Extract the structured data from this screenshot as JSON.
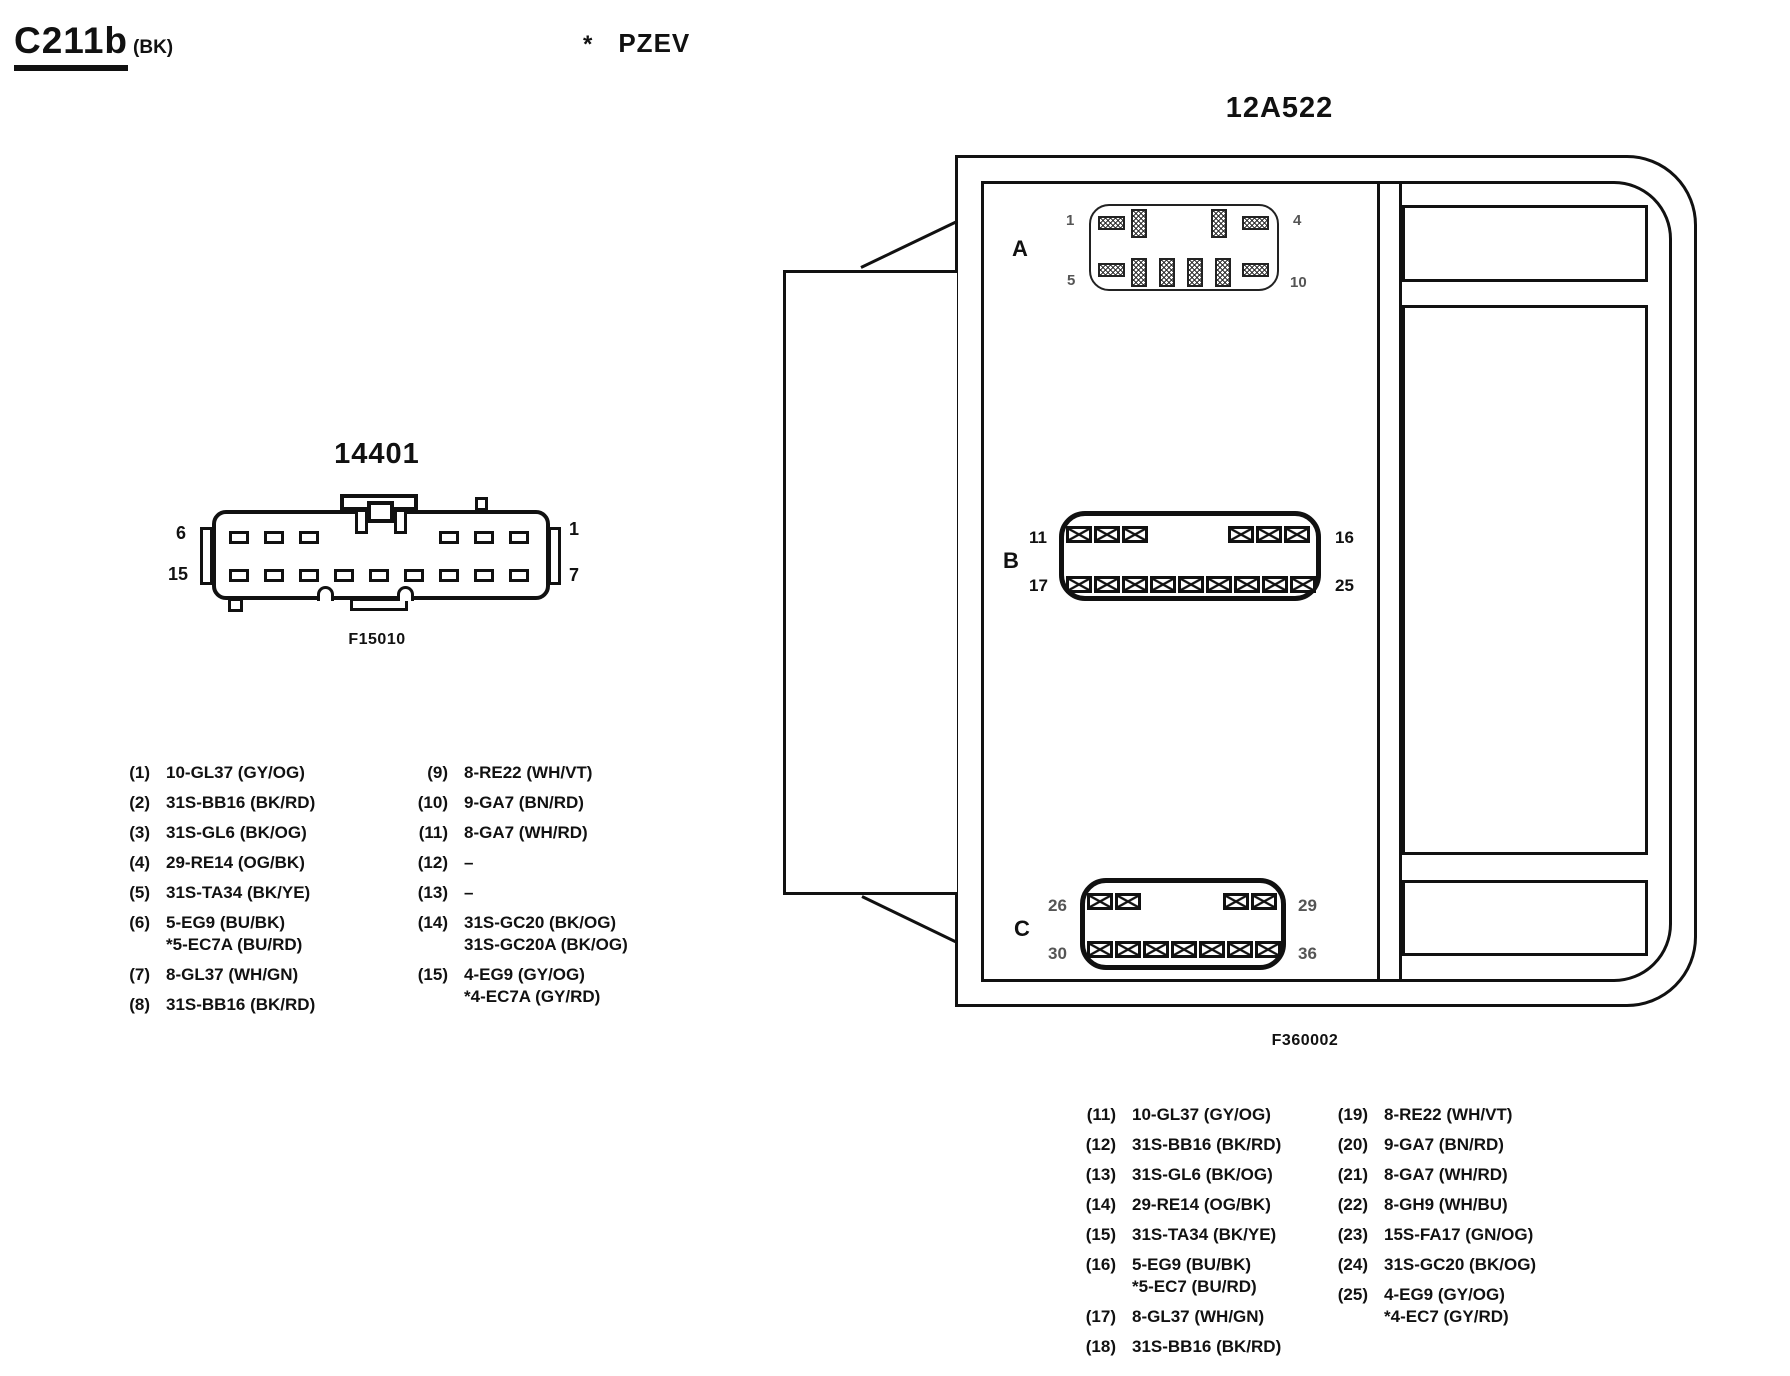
{
  "page": {
    "title": "C211b",
    "title_suffix": "(BK)",
    "footnote_marker": "*",
    "footnote_text": "PZEV",
    "ink": "#111111",
    "paper": "#ffffff"
  },
  "connector_14401": {
    "label": "14401",
    "caption": "F15010",
    "pin_labels": {
      "top_left": "6",
      "bottom_left": "15",
      "top_right": "1",
      "bottom_right": "7"
    }
  },
  "module_12a522": {
    "label": "12A522",
    "caption": "F360002",
    "connector_a": {
      "label": "A",
      "pin_top_left": "1",
      "pin_top_right": "4",
      "pin_bottom_left": "5",
      "pin_bottom_right": "10"
    },
    "connector_b": {
      "label": "B",
      "pin_top_left": "11",
      "pin_top_right": "16",
      "pin_bottom_left": "17",
      "pin_bottom_right": "25"
    },
    "connector_c": {
      "label": "C",
      "pin_top_left": "26",
      "pin_top_right": "29",
      "pin_bottom_left": "30",
      "pin_bottom_right": "36"
    }
  },
  "left_list": {
    "col1": [
      {
        "num": "(1)",
        "text": "10-GL37 (GY/OG)"
      },
      {
        "num": "(2)",
        "text": "31S-BB16 (BK/RD)"
      },
      {
        "num": "(3)",
        "text": "31S-GL6 (BK/OG)"
      },
      {
        "num": "(4)",
        "text": "29-RE14 (OG/BK)"
      },
      {
        "num": "(5)",
        "text": "31S-TA34 (BK/YE)"
      },
      {
        "num": "(6)",
        "text": "5-EG9 (BU/BK)\n*5-EC7A (BU/RD)"
      },
      {
        "num": "(7)",
        "text": "8-GL37 (WH/GN)"
      },
      {
        "num": "(8)",
        "text": "31S-BB16 (BK/RD)"
      }
    ],
    "col2": [
      {
        "num": "(9)",
        "text": "8-RE22 (WH/VT)"
      },
      {
        "num": "(10)",
        "text": "9-GA7 (BN/RD)"
      },
      {
        "num": "(11)",
        "text": "8-GA7 (WH/RD)"
      },
      {
        "num": "(12)",
        "text": "–"
      },
      {
        "num": "(13)",
        "text": "–"
      },
      {
        "num": "(14)",
        "text": "31S-GC20 (BK/OG)\n31S-GC20A (BK/OG)"
      },
      {
        "num": "(15)",
        "text": "4-EG9 (GY/OG)\n*4-EC7A (GY/RD)"
      }
    ]
  },
  "right_list": {
    "col1": [
      {
        "num": "(11)",
        "text": "10-GL37 (GY/OG)"
      },
      {
        "num": "(12)",
        "text": "31S-BB16 (BK/RD)"
      },
      {
        "num": "(13)",
        "text": "31S-GL6 (BK/OG)"
      },
      {
        "num": "(14)",
        "text": "29-RE14 (OG/BK)"
      },
      {
        "num": "(15)",
        "text": "31S-TA34 (BK/YE)"
      },
      {
        "num": "(16)",
        "text": "5-EG9 (BU/BK)\n*5-EC7 (BU/RD)"
      },
      {
        "num": "(17)",
        "text": "8-GL37 (WH/GN)"
      },
      {
        "num": "(18)",
        "text": "31S-BB16 (BK/RD)"
      }
    ],
    "col2": [
      {
        "num": "(19)",
        "text": "8-RE22 (WH/VT)"
      },
      {
        "num": "(20)",
        "text": "9-GA7 (BN/RD)"
      },
      {
        "num": "(21)",
        "text": "8-GA7 (WH/RD)"
      },
      {
        "num": "(22)",
        "text": "8-GH9 (WH/BU)"
      },
      {
        "num": "(23)",
        "text": "15S-FA17 (GN/OG)"
      },
      {
        "num": "(24)",
        "text": "31S-GC20 (BK/OG)"
      },
      {
        "num": "(25)",
        "text": "4-EG9 (GY/OG)\n*4-EC7 (GY/RD)"
      }
    ]
  }
}
